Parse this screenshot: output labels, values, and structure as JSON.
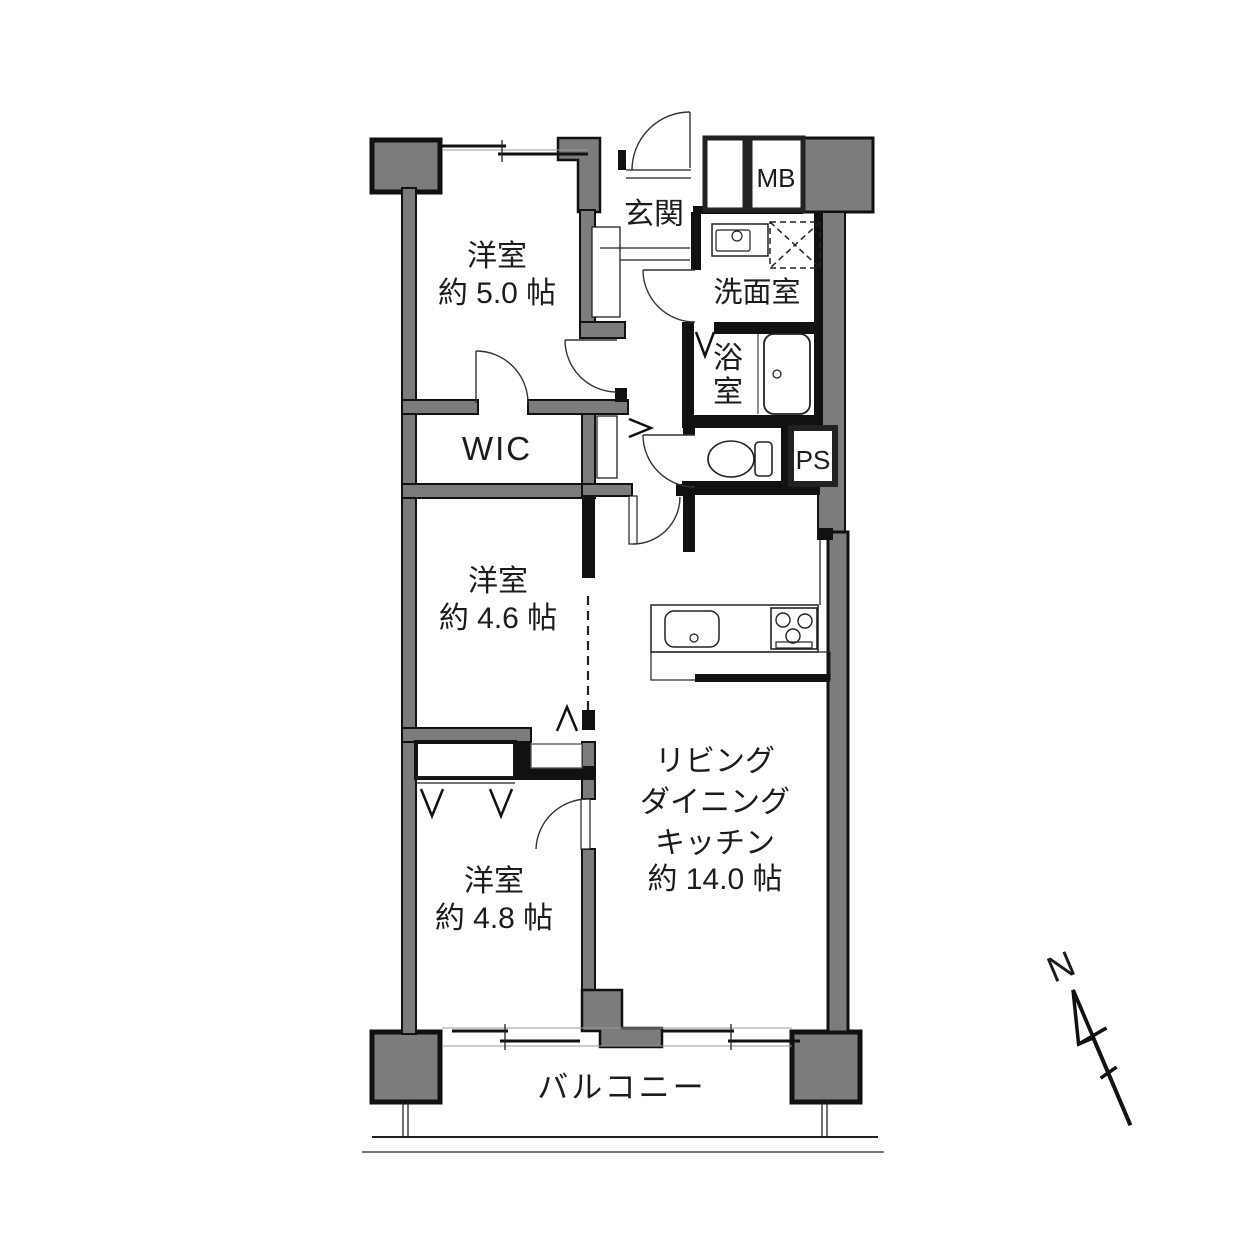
{
  "plan": {
    "rooms": {
      "bedroom1": {
        "name": "洋室",
        "size": "約 5.0 帖"
      },
      "bedroom2": {
        "name": "洋室",
        "size": "約 4.6 帖"
      },
      "bedroom3": {
        "name": "洋室",
        "size": "約 4.8 帖"
      },
      "ldk": {
        "line1": "リビング",
        "line2": "ダイニング",
        "line3": "キッチン",
        "size": "約 14.0 帖"
      },
      "entrance": {
        "name": "玄関"
      },
      "washroom": {
        "name": "洗面室"
      },
      "bathroom": {
        "char1": "浴",
        "char2": "室"
      },
      "wic": {
        "name": "WIC"
      },
      "meter_box": {
        "name": "MB"
      },
      "pipe_space": {
        "name": "PS"
      },
      "balcony": {
        "name": "バルコニー"
      }
    },
    "compass": {
      "north_label": "N"
    },
    "colors": {
      "wall_gray": "#7c7c7c",
      "line_black": "#111111",
      "background": "#ffffff"
    }
  }
}
